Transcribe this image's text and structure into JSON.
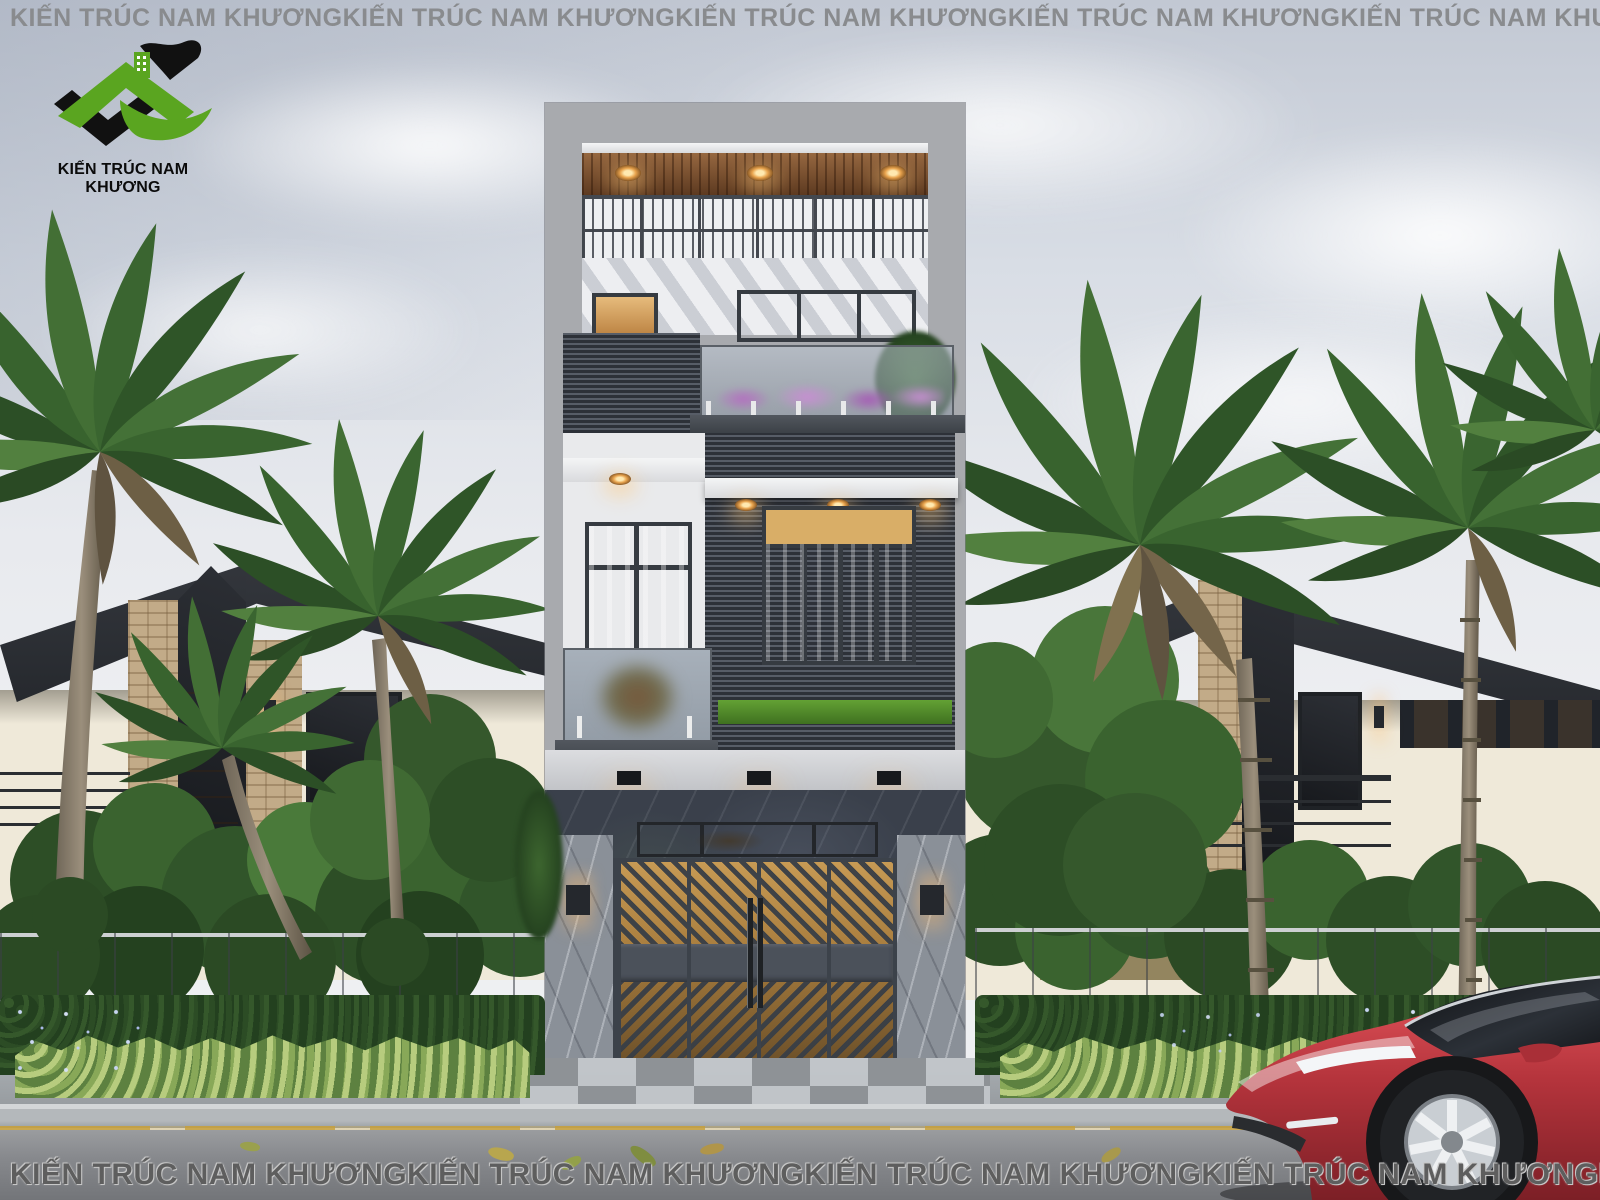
{
  "watermark": {
    "text": "KIẾN TRÚC NAM KHƯƠNG"
  },
  "logo": {
    "caption": "KIẾN TRÚC NAM KHƯƠNG"
  },
  "colors": {
    "sky_top": "#c2c8d3",
    "sky_bottom": "#f0f1f4",
    "building_frame_gray": "#a8aaae",
    "wood_ceiling_brown": "#7c4d2b",
    "cladding_dark_gray": "#3e444e",
    "marble_dark": "#3a404b",
    "marble_light": "#8a9098",
    "warm_window_glow": "#e6bb7c",
    "gate_metal_gray": "#4b515a",
    "palm_green": "#3a632f",
    "hedge_green": "#23401f",
    "plant_light_green": "#b7cc7e",
    "neighbor_wall_cream": "#efe9d9",
    "fence_gray": "#b3b6b9",
    "car_red": "#c23b42",
    "watermark_gray": "#898b8e",
    "logo_green": "#5aa520",
    "logo_black": "#111111"
  }
}
